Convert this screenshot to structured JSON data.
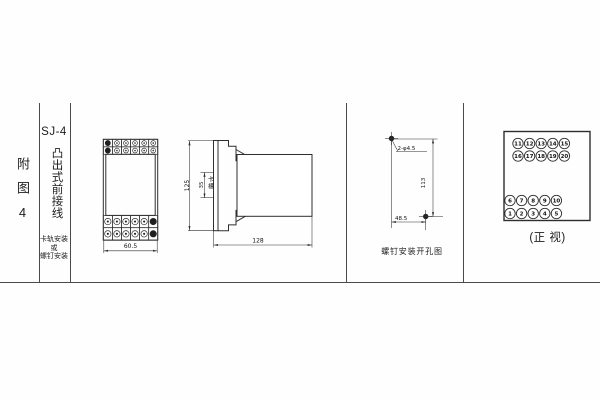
{
  "sheet": {
    "figure_label": "附图4",
    "series": {
      "model": "SJ-4",
      "type": "凸出式前接线",
      "mounting": [
        "卡轨安装",
        "或",
        "螺钉安装"
      ]
    },
    "front_view": {
      "width_dim": "60.5"
    },
    "side_view": {
      "height_dim": "125",
      "slot_dim": "35",
      "slot_label": "卡槽",
      "depth_dim": "128"
    },
    "hole_diagram": {
      "holes_label": "2-φ4.5",
      "vertical_dim": "113",
      "horizontal_dim": "48.5",
      "caption": "螺钉安装开孔图"
    },
    "terminal_view": {
      "caption": "(正 视)",
      "top_rows": [
        [
          "11",
          "12",
          "13",
          "14",
          "15"
        ],
        [
          "16",
          "17",
          "18",
          "19",
          "20"
        ]
      ],
      "bottom_rows": [
        [
          "6",
          "7",
          "8",
          "9",
          "10"
        ],
        [
          "1",
          "2",
          "3",
          "4",
          "5"
        ]
      ]
    }
  }
}
